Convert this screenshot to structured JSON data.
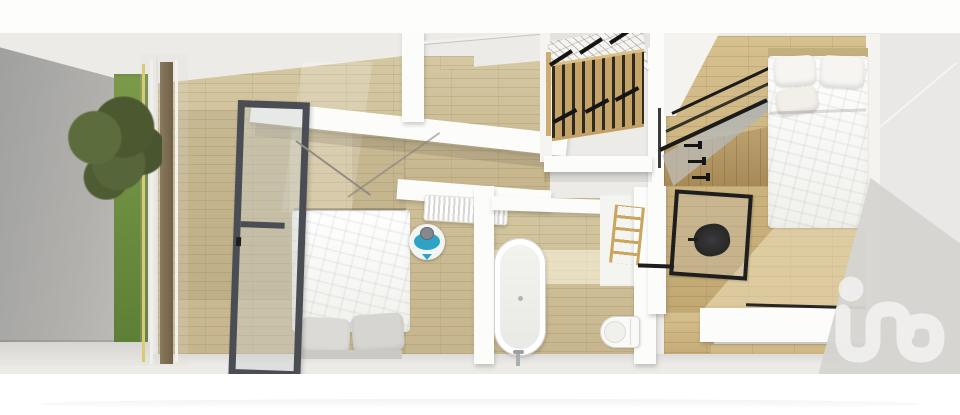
{
  "meta": {
    "description": "3D rendered top-down dollhouse floor plan of an apartment level with two bedrooms, a landing with staircase and a bathroom"
  },
  "colors": {
    "wall": "#fcfcfa",
    "wood": "#c6b58c",
    "wood-hi": "#d4c7a1",
    "wood-warm": "#c2a872",
    "backdrop": "#ecebe8",
    "exterior": "#a9a8a5",
    "grass": "#6f9140",
    "foliage": "#516034",
    "frame-dark": "#4a4e54",
    "glass": "#cdd3d4",
    "accent": "#2da4c6",
    "chair": "#2a2a2a",
    "shadow": "#d5d4d1",
    "watermark-white": "#ffffff"
  },
  "watermark": {
    "label": "in",
    "opacity": "0.6"
  },
  "scene": {
    "exterior": [
      "side-wall",
      "garden-strip",
      "tree",
      "glazed-facade"
    ],
    "rooms": [
      {
        "name": "bedroom-left",
        "elements": [
          "double-bed",
          "grey-pillows",
          "open-glass-door",
          "person-marker",
          "radiator"
        ]
      },
      {
        "name": "landing",
        "elements": [
          "staircase",
          "wood-balusters",
          "handrail-brackets"
        ]
      },
      {
        "name": "bathroom",
        "elements": [
          "freestanding-bathtub",
          "toilet",
          "ladder-towel-rack"
        ]
      },
      {
        "name": "bedroom-right",
        "elements": [
          "double-bed",
          "pillows",
          "glass-canopy",
          "wardrobe",
          "wall-hooks",
          "glass-partition",
          "desk-chair"
        ]
      }
    ]
  }
}
